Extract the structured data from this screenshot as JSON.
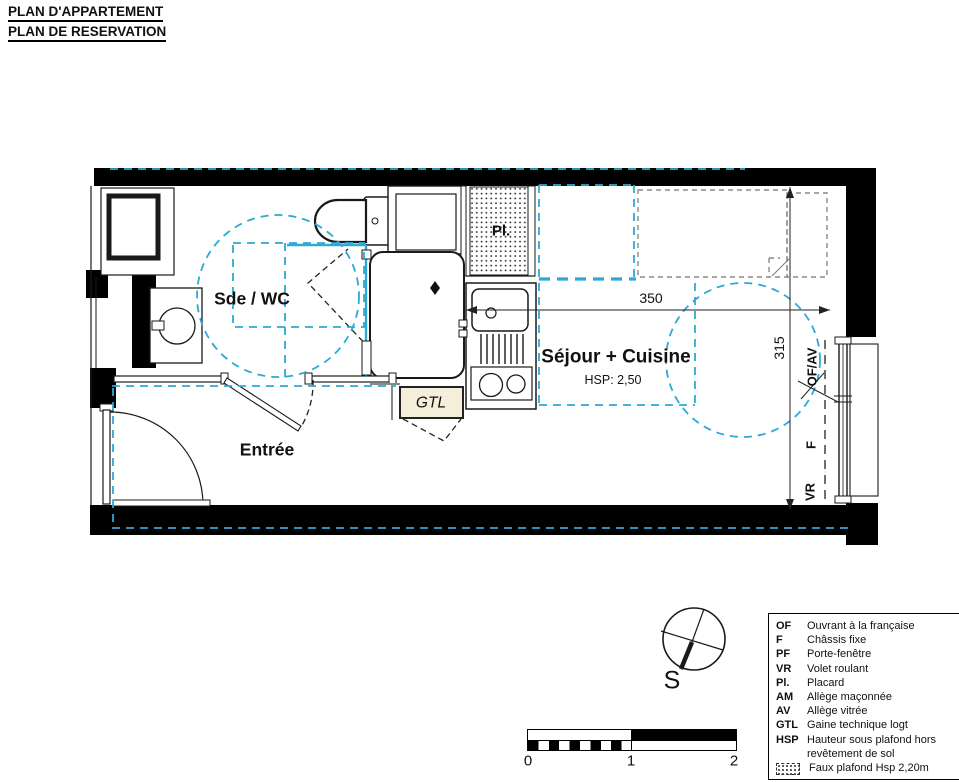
{
  "header": {
    "title_line1": "PLAN D'APPARTEMENT",
    "title_line2": "PLAN DE RESERVATION"
  },
  "rooms": {
    "sde_wc": "Sde / WC",
    "entree": "Entrée",
    "sejour": "Séjour + Cuisine",
    "sejour_hsp": "HSP: 2,50",
    "placard": "Pl.",
    "gtl": "GTL"
  },
  "dimensions": {
    "width_cm": "350",
    "height_cm": "315"
  },
  "window_labels": {
    "of_av": "OF/AV",
    "f": "F",
    "vr": "VR"
  },
  "compass": {
    "south_label": "S"
  },
  "scale_bar": {
    "tick0": "0",
    "tick1": "1",
    "tick2": "2"
  },
  "legend": {
    "items": [
      {
        "abbr": "OF",
        "label": "Ouvrant à la française"
      },
      {
        "abbr": "F",
        "label": "Châssis fixe"
      },
      {
        "abbr": "PF",
        "label": "Porte-fenêtre"
      },
      {
        "abbr": "VR",
        "label": "Volet roulant"
      },
      {
        "abbr": "Pl.",
        "label": "Placard"
      },
      {
        "abbr": "AM",
        "label": "Allège maçonnée"
      },
      {
        "abbr": "AV",
        "label": "Allège vitrée"
      },
      {
        "abbr": "GTL",
        "label": "Gaine technique logt"
      },
      {
        "abbr": "HSP",
        "label": "Hauteur sous plafond hors revêtement de sol"
      },
      {
        "abbr": "",
        "icon": "faux-plafond-swatch",
        "label": "Faux plafond Hsp 2,20m"
      }
    ]
  },
  "theme": {
    "cyan": "#2ea9d6",
    "gray_dash": "#8a8a8a",
    "wall": "#000000",
    "line": "#1a1a1a",
    "gtl_fill": "#f3efda"
  }
}
